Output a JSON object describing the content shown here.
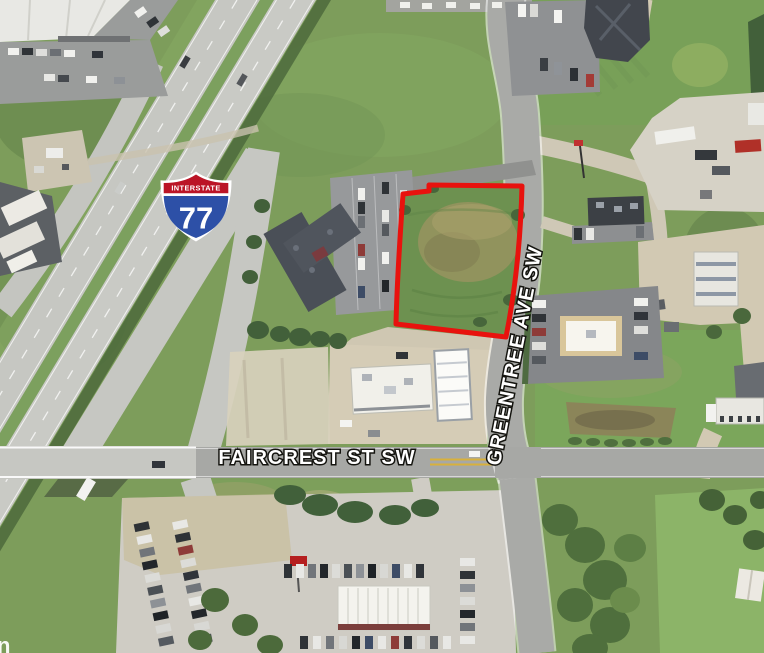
{
  "map": {
    "type": "aerial-satellite-photo",
    "street_labels": [
      {
        "id": "faircrest",
        "text": "FAIRCREST ST SW"
      },
      {
        "id": "greentree",
        "text": "GREENTREE AVE SW"
      }
    ],
    "interstate_shield": {
      "header": "INTERSTATE",
      "number": "77"
    },
    "parcel": {
      "outline_color": "#e8120e",
      "description": "vacant grass parcel outlined in red at Greentree Ave SW"
    },
    "watermark": "n",
    "colors": {
      "shield_red": "#bb1426",
      "shield_blue": "#2d50a7",
      "shield_border": "#ffffff",
      "label_text": "#ffffff"
    },
    "features": [
      "interstate-77-highway",
      "highway-overpass-bridge",
      "faircrest-st-sw-road",
      "greentree-ave-sw-road",
      "red-outlined-vacant-parcel",
      "hotel-with-parking-lot",
      "gas-station-with-fuel-canopy",
      "fast-food-restaurant",
      "restaurant-building",
      "truck-stop-parking",
      "truck-wash-building",
      "car-dealership-lot",
      "industrial-warehouse",
      "office-building",
      "residential-house",
      "tree-clusters",
      "grass-fields"
    ]
  }
}
